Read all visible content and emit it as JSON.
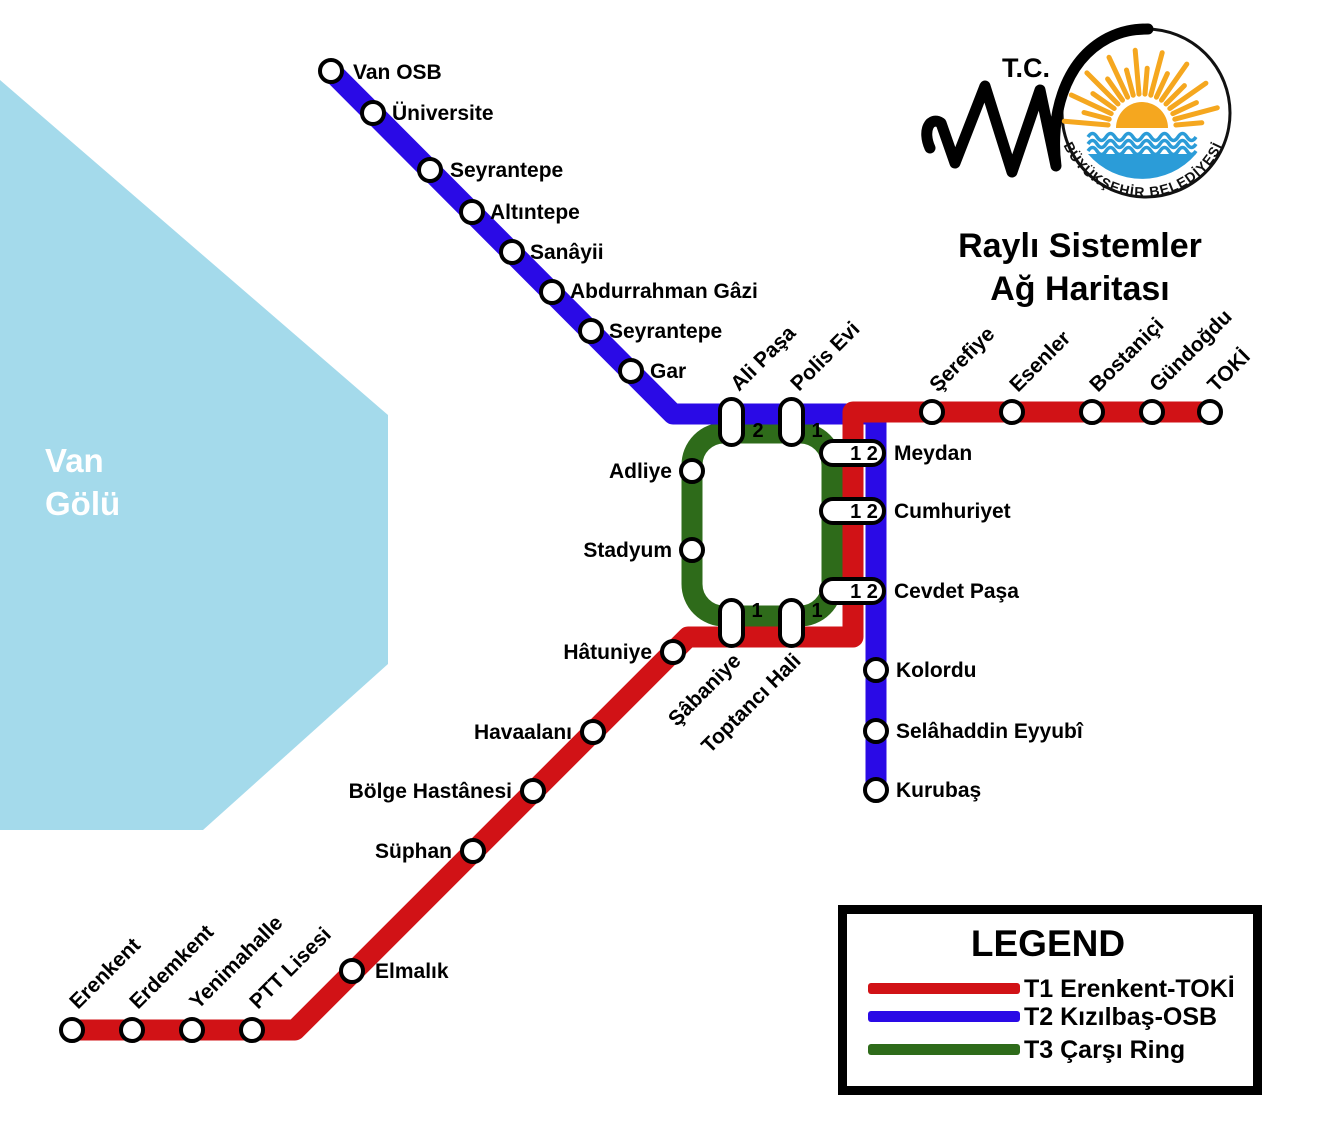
{
  "header": {
    "tc": "T.C.",
    "arc_text": "BÜYÜKŞEHİR BELEDİYESİ",
    "title1": "Raylı Sistemler",
    "title2": "Ağ Haritası"
  },
  "lake": {
    "name1": "Van",
    "name2": "Gölü",
    "color": "#A4DAEB"
  },
  "logo_colors": {
    "sun": "#F5A71F",
    "sea": "#2B9CD8"
  },
  "legend": {
    "title": "LEGEND",
    "items": [
      {
        "id": "t1",
        "label": "T1 Erenkent-TOKİ",
        "color": "#D11216"
      },
      {
        "id": "t2",
        "label": "T2 Kızılbaş-OSB",
        "color": "#2A0AE6"
      },
      {
        "id": "t3",
        "label": "T3 Çarşı Ring",
        "color": "#2E6B1A"
      }
    ]
  },
  "stations": {
    "van_osb": "Van OSB",
    "universite": "Üniversite",
    "seyrantepe1": "Seyrantepe",
    "altintepe": "Altıntepe",
    "sanayii": "Sanâyii",
    "abdurrahman_gazi": "Abdurrahman Gâzi",
    "seyrantepe2": "Seyrantepe",
    "gar": "Gar",
    "ali_pasa": "Ali Paşa",
    "polis_evi": "Polis Evi",
    "serefiye": "Şerefiye",
    "esenler": "Esenler",
    "bostanici": "Bostaniçi",
    "gundogdu": "Gündoğdu",
    "toki": "TOKİ",
    "meydan": "Meydan",
    "cumhuriyet": "Cumhuriyet",
    "cevdet_pasa": "Cevdet Paşa",
    "kolordu": "Kolordu",
    "selahaddin_eyyubi": "Selâhaddin Eyyubî",
    "kurubas": "Kurubaş",
    "adliye": "Adliye",
    "stadyum": "Stadyum",
    "sabaniye": "Şâbaniye",
    "toptanci_hali": "Toptancı Hali",
    "hatuniye": "Hâtuniye",
    "havaalani": "Havaalanı",
    "bolge_hastanesi": "Bölge Hastânesi",
    "suphan": "Süphan",
    "elmalik": "Elmalık",
    "ptt_lisesi": "PTT Lisesi",
    "yenimahalle": "Yenimahalle",
    "erdemkent": "Erdemkent",
    "erenkent": "Erenkent"
  },
  "badges": {
    "ali_pasa": "2",
    "polis_evi": "1",
    "sabaniye": "1",
    "toptanci_hali": "1",
    "meydan": "1 2",
    "cumhuriyet": "1 2",
    "cevdet_pasa": "1 2"
  }
}
